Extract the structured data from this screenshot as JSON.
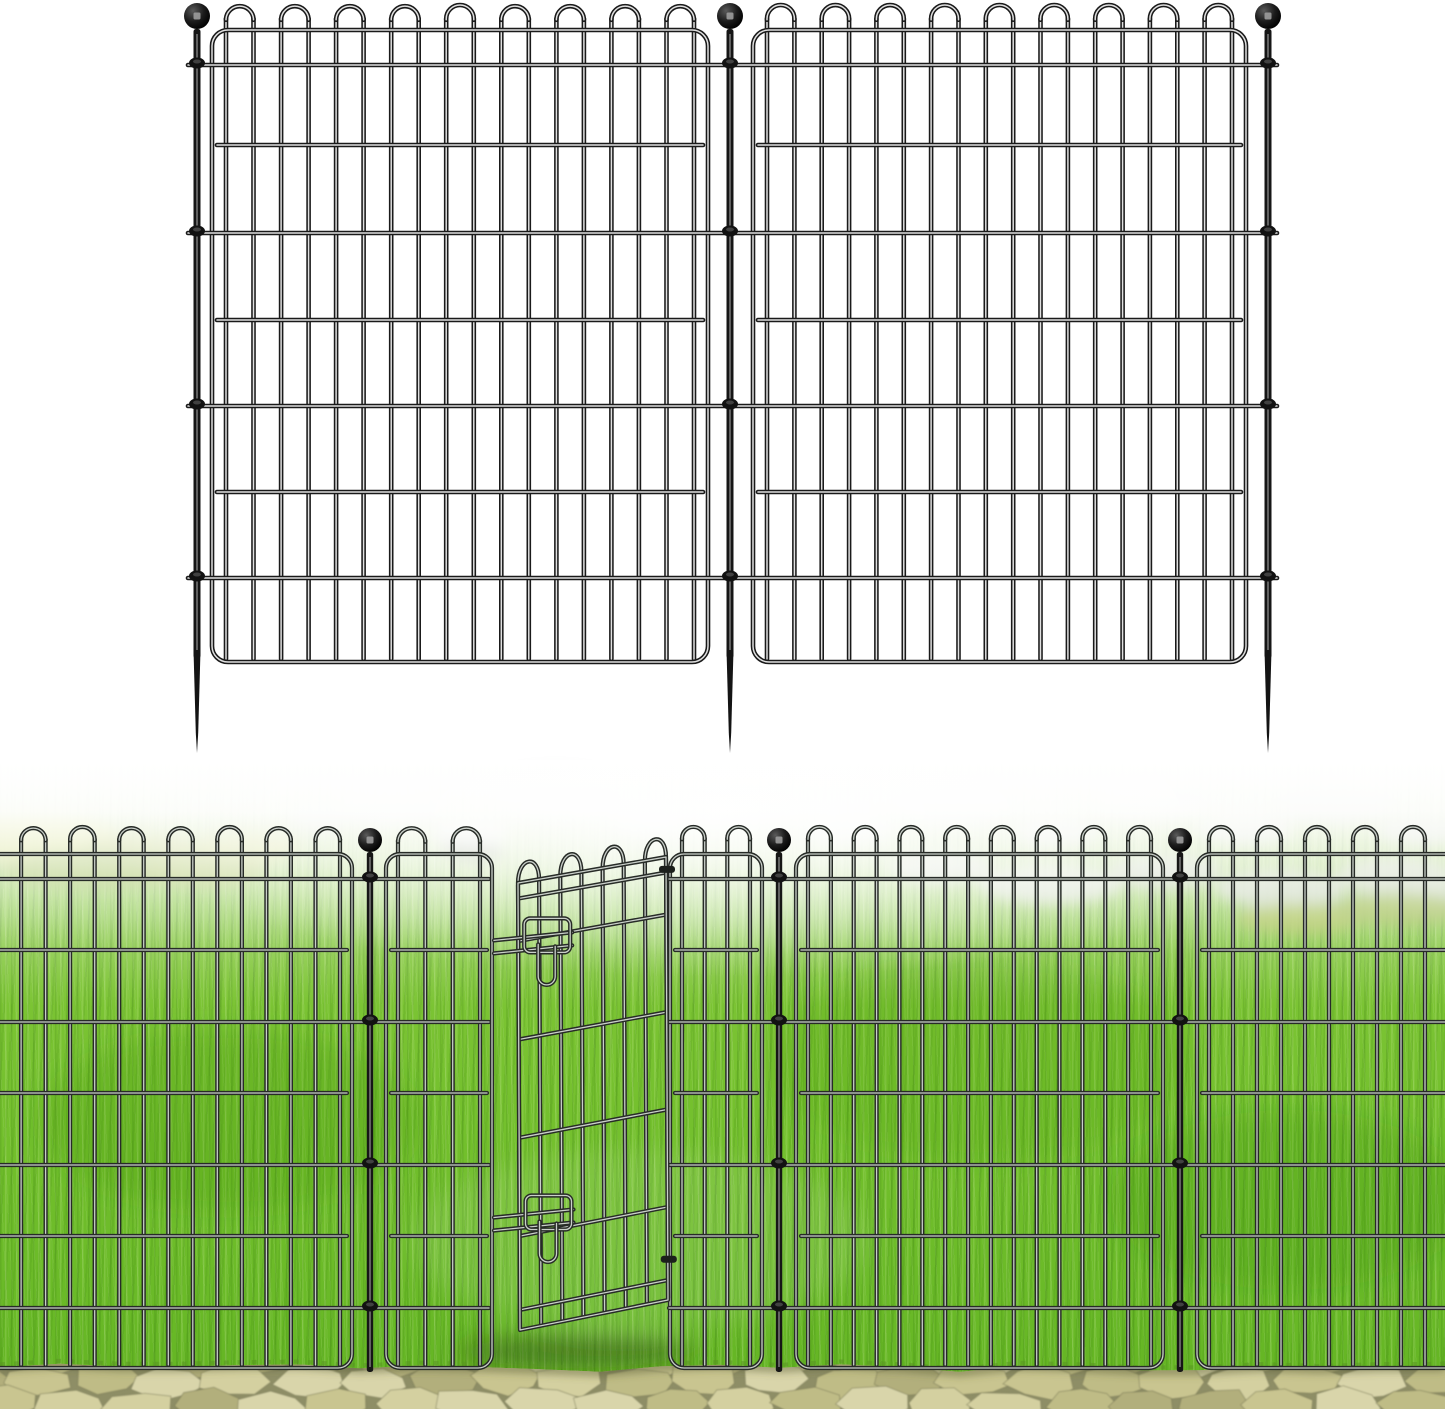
{
  "meta": {
    "description": "Product image of black metal garden border fence: top half is a technical illustration of two decorative loop-top wire fence panels joined by three ball-top ground stakes on white; bottom half shows the fence installed on bright green lawn with an open walk-through gate, foggy stone horizon and a paver stone path in the foreground.",
    "visible_text": []
  },
  "colors": {
    "background": "#ffffff",
    "diagram_wire_dark": "#1a1a1a",
    "diagram_wire_light": "#e0e0e0",
    "scene_wire_dark": "#272b27",
    "scene_wire_light": "#c9cfc9",
    "stake_metal": "#161616",
    "grass_main": "#7cc434",
    "grass_deep": "#62b322",
    "path_gap": "#8e8e66",
    "fog": "#ffffff"
  },
  "top_diagram": {
    "stakes_x": [
      197,
      730,
      1268
    ],
    "ball": {
      "cy": 16,
      "r": 13
    },
    "shaft": {
      "top": 29,
      "bottom": 658,
      "width": 7
    },
    "spike": {
      "start": 650,
      "tip": 753
    },
    "panels": [
      {
        "x0": 212,
        "x1": 708
      },
      {
        "x0": 753,
        "x1": 1246
      }
    ],
    "frame": {
      "top": 30,
      "bottom": 662,
      "radius": 16
    },
    "loop_peak": 5,
    "rails_full": {
      "y": [
        65,
        233,
        406,
        578
      ],
      "x0": 188,
      "x1": 1277
    },
    "rails_panel": [
      145,
      320,
      492
    ],
    "wire_spacing": 27.5,
    "edge_inset": 14,
    "wire_style": {
      "dark": "#1a1a1a",
      "light": "#e0e0e0",
      "dark_w": 4.6,
      "light_w": 1.5
    }
  },
  "bottom_scene": {
    "top": 760,
    "fence": {
      "posts_x": [
        370,
        779,
        1180
      ],
      "ball": {
        "cy": 840,
        "r": 12
      },
      "shaft": {
        "top": 852,
        "bottom": 1372,
        "width": 6.4
      },
      "panels": [
        {
          "x0": -40,
          "x1": 352
        },
        {
          "x0": 386,
          "x1": 492
        },
        {
          "x0": 670,
          "x1": 762
        },
        {
          "x0": 796,
          "x1": 1163
        },
        {
          "x0": 1197,
          "x1": 1485
        }
      ],
      "frame": {
        "top": 854,
        "bottom": 1368,
        "radius": 14
      },
      "loop_peak": 827,
      "rails_full": {
        "y": [
          879,
          1022,
          1165,
          1308
        ],
        "segments": [
          [
            -12,
            489
          ],
          [
            669,
            1457
          ]
        ]
      },
      "rails_panel": [
        950,
        1093,
        1236
      ],
      "wire_spacing": 23.5,
      "edge_inset": 12,
      "wire_style": {
        "dark": "#272b27",
        "light": "#c9cfc9",
        "dark_w": 4.2,
        "light_w": 1.3
      }
    },
    "gate": {
      "tl": [
        518,
        883
      ],
      "tr": [
        666,
        857
      ],
      "br": [
        668,
        1300
      ],
      "bl": [
        520,
        1330
      ],
      "verticals": 8,
      "rails_f": [
        0.035,
        0.13,
        0.35,
        0.57,
        0.79,
        0.955
      ],
      "loop_height": 26,
      "latches_f": [
        0.115,
        0.735
      ],
      "bolt_reach_x": 494,
      "hinge_f": [
        0.02,
        0.9
      ]
    },
    "horizon": {
      "stones": [
        [
          390,
          806,
          55,
          20
        ],
        [
          470,
          832,
          38,
          15
        ],
        [
          555,
          795,
          65,
          22
        ],
        [
          645,
          822,
          34,
          13
        ],
        [
          745,
          800,
          52,
          18
        ],
        [
          850,
          828,
          42,
          15
        ],
        [
          955,
          803,
          60,
          20
        ],
        [
          1055,
          832,
          40,
          14
        ],
        [
          1150,
          800,
          58,
          19
        ],
        [
          1245,
          828,
          48,
          16
        ],
        [
          1335,
          803,
          60,
          20
        ],
        [
          1420,
          830,
          44,
          15
        ],
        [
          940,
          868,
          52,
          16
        ],
        [
          1050,
          884,
          72,
          20
        ],
        [
          1165,
          872,
          56,
          17
        ],
        [
          1280,
          888,
          66,
          19
        ],
        [
          1395,
          876,
          60,
          18
        ],
        [
          1440,
          900,
          50,
          15
        ],
        [
          320,
          818,
          30,
          12
        ]
      ],
      "stone_colors": [
        "#c6d0bc",
        "#cfd8c7",
        "#bcc8b1",
        "#c9d3c1"
      ],
      "bushes": [
        [
          35,
          838,
          85,
          26
        ],
        [
          145,
          852,
          65,
          20
        ],
        [
          248,
          846,
          52,
          17
        ],
        [
          95,
          868,
          95,
          20
        ],
        [
          205,
          870,
          60,
          16
        ],
        [
          1300,
          918,
          64,
          16
        ],
        [
          1400,
          908,
          70,
          17
        ]
      ],
      "bush_colors": [
        "#c8d45c",
        "#a9bd45",
        "#b9c84f",
        "#8fb23c",
        "#9cb843",
        "#a3bd48",
        "#95b53f"
      ],
      "shrubs": [
        [
          475,
          850,
          28,
          10
        ],
        [
          452,
          845,
          12,
          6
        ]
      ],
      "shrub_color": "#3f5224",
      "grass_patches": [
        [
          230,
          1120,
          190,
          90,
          "rgba(60,140,20,0.20)"
        ],
        [
          640,
          1240,
          230,
          90,
          "rgba(255,255,255,0.10)"
        ],
        [
          980,
          1060,
          210,
          100,
          "rgba(70,150,25,0.16)"
        ],
        [
          1290,
          1200,
          180,
          90,
          "rgba(50,130,15,0.18)"
        ],
        [
          575,
          1352,
          120,
          16,
          "rgba(45,65,15,0.45)"
        ]
      ]
    },
    "path": {
      "top": 1366,
      "gap_color": "#8e8e66",
      "palette": [
        "#d4d0a0",
        "#c9c590",
        "#bfbc86",
        "#d9d5aa",
        "#b2af7c"
      ],
      "row_y": [
        1357,
        1381,
        1405
      ],
      "row_offset": [
        18,
        0,
        35
      ],
      "step": 67,
      "seed": 7,
      "shadow_color": "rgba(85,90,50,0.5)",
      "fringe_color": "rgba(90,150,35,0.55)"
    }
  }
}
